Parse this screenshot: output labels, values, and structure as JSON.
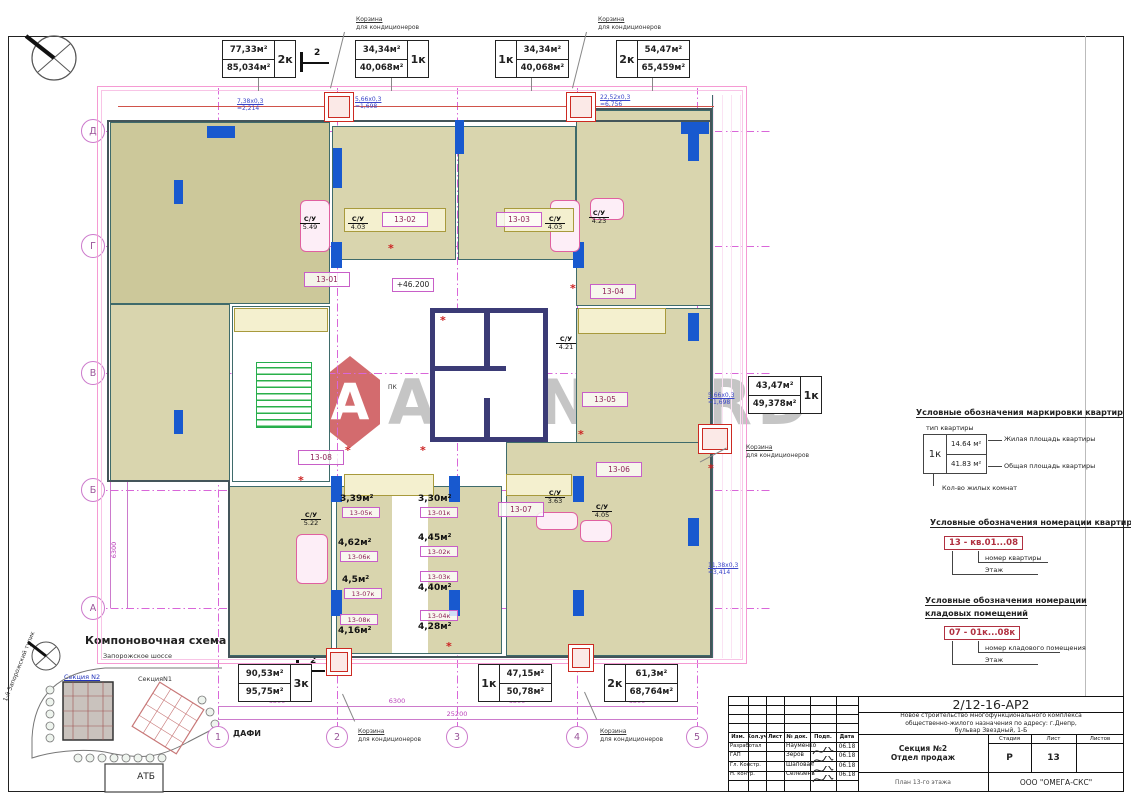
{
  "watermark": {
    "text": "AVANGARD",
    "logo_letter": "A"
  },
  "axes": {
    "rows": [
      {
        "label": "Д",
        "y": 131
      },
      {
        "label": "Г",
        "y": 246
      },
      {
        "label": "В",
        "y": 373
      },
      {
        "label": "Б",
        "y": 490
      },
      {
        "label": "А",
        "y": 608
      }
    ],
    "cols": [
      {
        "label": "1",
        "x": 218
      },
      {
        "label": "2",
        "x": 337
      },
      {
        "label": "3",
        "x": 457
      },
      {
        "label": "4",
        "x": 577
      },
      {
        "label": "5",
        "x": 697
      }
    ],
    "row_dims": [
      "6300",
      "6300",
      "6300",
      "6300"
    ],
    "col_dims": [
      "6300",
      "6300",
      "6300",
      "6300"
    ],
    "total_dim": "25200"
  },
  "apartments": [
    {
      "living": "77,33м²",
      "total": "85,034м²",
      "type": "2к",
      "side": "right",
      "x": 222,
      "y": 40
    },
    {
      "living": "34,34м²",
      "total": "40,068м²",
      "type": "1к",
      "side": "right",
      "x": 355,
      "y": 40
    },
    {
      "living": "34,34м²",
      "total": "40,068м²",
      "type": "1к",
      "side": "left",
      "x": 495,
      "y": 40
    },
    {
      "living": "54,47м²",
      "total": "65,459м²",
      "type": "2к",
      "side": "left",
      "x": 616,
      "y": 40
    },
    {
      "living": "43,47м²",
      "total": "49,378м²",
      "type": "1к",
      "side": "right",
      "x": 748,
      "y": 376
    },
    {
      "living": "90,53м²",
      "total": "95,75м²",
      "type": "3к",
      "side": "right",
      "x": 238,
      "y": 664
    },
    {
      "living": "47,15м²",
      "total": "50,78м²",
      "type": "1к",
      "side": "left",
      "x": 478,
      "y": 664
    },
    {
      "living": "61,3м²",
      "total": "68,764м²",
      "type": "2к",
      "side": "left",
      "x": 604,
      "y": 664
    }
  ],
  "room_labels": [
    {
      "num": "13-01",
      "x": 304,
      "y": 272
    },
    {
      "num": "13-02",
      "x": 382,
      "y": 212
    },
    {
      "num": "13-03",
      "x": 496,
      "y": 212
    },
    {
      "num": "13-04",
      "x": 590,
      "y": 284
    },
    {
      "num": "13-05",
      "x": 582,
      "y": 392
    },
    {
      "num": "13-06",
      "x": 596,
      "y": 462
    },
    {
      "num": "13-07",
      "x": 498,
      "y": 502
    },
    {
      "num": "13-08",
      "x": 298,
      "y": 450
    }
  ],
  "storages": [
    {
      "area": "3,39м²",
      "num": "13-05к",
      "x": 340,
      "y": 494,
      "area_first": true
    },
    {
      "area": "3,30м²",
      "num": "13-01к",
      "x": 418,
      "y": 494,
      "area_first": true
    },
    {
      "area": "4,62м²",
      "num": "13-06к",
      "x": 338,
      "y": 538,
      "area_first": true
    },
    {
      "area": "4,45м²",
      "num": "13-02к",
      "x": 418,
      "y": 533,
      "area_first": true
    },
    {
      "area": "4,5м²",
      "num": "13-07к",
      "x": 342,
      "y": 575,
      "area_first": true
    },
    {
      "area": "4,40м²",
      "num": "13-03к",
      "x": 418,
      "y": 571,
      "area_first": false
    },
    {
      "area": "4,16м²",
      "num": "13-08к",
      "x": 338,
      "y": 614,
      "area_first": false
    },
    {
      "area": "4,28м²",
      "num": "13-04к",
      "x": 418,
      "y": 610,
      "area_first": false
    }
  ],
  "wc_label": "С/У",
  "wc": [
    {
      "v": "5.49",
      "x": 300,
      "y": 216
    },
    {
      "v": "4.03",
      "x": 348,
      "y": 216
    },
    {
      "v": "4.03",
      "x": 545,
      "y": 216
    },
    {
      "v": "4.23",
      "x": 589,
      "y": 210
    },
    {
      "v": "4.21",
      "x": 556,
      "y": 336
    },
    {
      "v": "5.22",
      "x": 301,
      "y": 512
    },
    {
      "v": "3.63",
      "x": 545,
      "y": 490
    },
    {
      "v": "4.05",
      "x": 592,
      "y": 504
    }
  ],
  "blue_dims": [
    {
      "l1": "7,38х0,3",
      "l2": "=2,214",
      "x": 237,
      "y": 98
    },
    {
      "l1": "5,66х0,3",
      "l2": "=1,698",
      "x": 355,
      "y": 96
    },
    {
      "l1": "22,52х0,3",
      "l2": "=6,756",
      "x": 600,
      "y": 94
    },
    {
      "l1": "5,66х0,3",
      "l2": "=1,698",
      "x": 708,
      "y": 392
    },
    {
      "l1": "11,38х0,3",
      "l2": "=3,414",
      "x": 708,
      "y": 562
    }
  ],
  "korzina": {
    "l1": "Корзина",
    "l2": "для кондиционеров",
    "positions": [
      [
        356,
        16
      ],
      [
        598,
        16
      ],
      [
        746,
        444
      ],
      [
        358,
        728
      ],
      [
        600,
        728
      ]
    ]
  },
  "notes": {
    "kanal1": "Канал",
    "kanal2": "см. ВК",
    "pk": "ПК",
    "level": "+46.200",
    "dafi": "ДАФИ",
    "section_label": "2"
  },
  "legend1": {
    "title": "Условные обозначения маркировки квартир",
    "tip": "тип квартиры",
    "type": "1к",
    "living": "14.64 м²",
    "total": "41.83 м²",
    "n1": "Жилая площадь квартиры",
    "n2": "Общая площадь квартиры",
    "n3": "Кол-во жилых комнат"
  },
  "legend2": {
    "title": "Условные обозначения номерации квартир",
    "code": "13 - кв.01...08",
    "n1": "номер квартиры",
    "n2": "Этаж"
  },
  "legend3": {
    "title1": "Условные обозначения номерации",
    "title2": "кладовых помещений",
    "code": "07 - 01к...08к",
    "n1": "номер кладового помещения",
    "n2": "Этаж"
  },
  "scheme": {
    "title": "Компоновочная схема",
    "road": "Запорожское шоссе",
    "s2": "Секция N2",
    "s1": "СекцияN1",
    "street": "1-й Запорожский тупик",
    "atb": "АТБ"
  },
  "titleblock": {
    "code": "2/12-16-АР2",
    "desc1": "Новое строительство многофункционального комплекса",
    "desc2": "общественно-жилого назначения по адресу: г.Днепр,",
    "desc3": "бульвар Звездный, 1-Б",
    "cols": [
      "Изм.",
      "Кол.уч",
      "Лист",
      "№ док.",
      "Подп.",
      "Дата"
    ],
    "rows": [
      {
        "role": "Разработал",
        "name": "Науменко",
        "date": "06.18"
      },
      {
        "role": "ГАП",
        "name": "Зеров",
        "date": "06.18"
      },
      {
        "role": "Гл. Констр.",
        "name": "Шаповал",
        "date": "06.18"
      },
      {
        "role": "Н. контр.",
        "name": "Селезень",
        "date": "06.18"
      }
    ],
    "section": "Секция №2",
    "dept": "Отдел продаж",
    "plan_name": "План 13-го этажа",
    "stage_cols": [
      "Стадия",
      "Лист",
      "Листов"
    ],
    "stage_value": "Р",
    "sheet_value": "13",
    "sheets_value": "",
    "org": "ООО \"ОМЕГА-СКС\""
  },
  "colors": {
    "room_fill": "#d9d5ae",
    "room_fill_dark": "#ccc89a",
    "grid_magenta": "#d966d9",
    "window_blue": "#1859cf",
    "core_navy": "#3b3b76",
    "stair_green": "#26ad4d",
    "accent_red": "#cc2a22",
    "label_magenta": "#c85fc8",
    "dim_blue": "#3a46c8",
    "legend_red": "#b03040",
    "watermark_gray": "#999999"
  }
}
